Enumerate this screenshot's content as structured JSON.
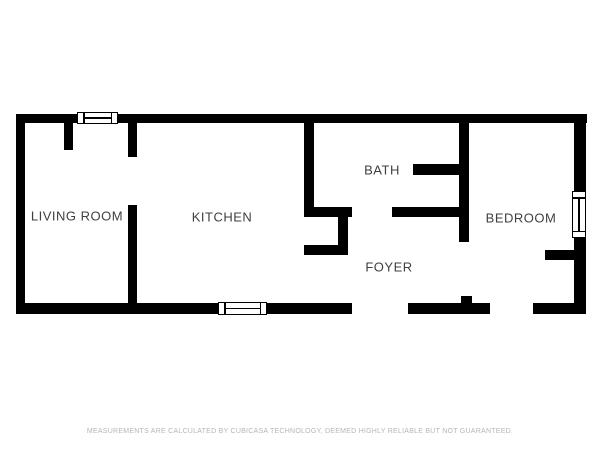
{
  "colors": {
    "background": "#ffffff",
    "wall": "#000000",
    "label": "#3f3f3f",
    "disclaimer": "#b5b5b5"
  },
  "rooms": [
    {
      "name": "living-room",
      "label": "LIVING ROOM"
    },
    {
      "name": "kitchen",
      "label": "KITCHEN"
    },
    {
      "name": "bath",
      "label": "BATH"
    },
    {
      "name": "foyer",
      "label": "FOYER"
    },
    {
      "name": "bedroom",
      "label": "BEDROOM"
    }
  ],
  "disclaimer": "MEASUREMENTS ARE CALCULATED BY CUBICASA TECHNOLOGY, DEEMED HIGHLY RELIABLE BUT NOT GUARANTEED.",
  "floorplan": {
    "walls": [
      {
        "id": "outer-top",
        "x": 16,
        "y": 114,
        "w": 571,
        "h": 9
      },
      {
        "id": "outer-left",
        "x": 16,
        "y": 114,
        "w": 9,
        "h": 200
      },
      {
        "id": "outer-right",
        "x": 574,
        "y": 114,
        "w": 12,
        "h": 200
      },
      {
        "id": "outer-bottom-left",
        "x": 16,
        "y": 303,
        "w": 336,
        "h": 11
      },
      {
        "id": "outer-bottom-mid",
        "x": 408,
        "y": 303,
        "w": 82,
        "h": 11
      },
      {
        "id": "outer-bottom-right",
        "x": 533,
        "y": 303,
        "w": 53,
        "h": 11
      },
      {
        "id": "living-room-stub",
        "x": 64,
        "y": 123,
        "w": 9,
        "h": 27
      },
      {
        "id": "living-kitchen-upper",
        "x": 128,
        "y": 123,
        "w": 9,
        "h": 34
      },
      {
        "id": "living-kitchen-lower",
        "x": 128,
        "y": 205,
        "w": 9,
        "h": 98
      },
      {
        "id": "kitchen-bath-divider",
        "x": 304,
        "y": 123,
        "w": 10,
        "h": 94
      },
      {
        "id": "bath-bottom-left",
        "x": 304,
        "y": 207,
        "w": 48,
        "h": 10
      },
      {
        "id": "bath-bottom-right",
        "x": 392,
        "y": 207,
        "w": 68,
        "h": 10
      },
      {
        "id": "foyer-closet-right",
        "x": 338,
        "y": 217,
        "w": 10,
        "h": 28
      },
      {
        "id": "foyer-closet-bottom",
        "x": 304,
        "y": 245,
        "w": 44,
        "h": 10
      },
      {
        "id": "bath-interior-stub",
        "x": 413,
        "y": 164,
        "w": 50,
        "h": 11
      },
      {
        "id": "bath-bedroom-divider",
        "x": 459,
        "y": 123,
        "w": 10,
        "h": 119
      },
      {
        "id": "foyer-bedroom-stub",
        "x": 461,
        "y": 296,
        "w": 11,
        "h": 8
      },
      {
        "id": "bedroom-closet-stub",
        "x": 545,
        "y": 250,
        "w": 29,
        "h": 10
      }
    ],
    "windows": [
      {
        "id": "living-room-window",
        "x": 77,
        "y": 112,
        "w": 41,
        "h": 12,
        "orient": "h"
      },
      {
        "id": "kitchen-window",
        "x": 218,
        "y": 302,
        "w": 49,
        "h": 13,
        "orient": "h"
      },
      {
        "id": "bedroom-window",
        "x": 572,
        "y": 191,
        "w": 14,
        "h": 47,
        "orient": "v"
      }
    ]
  }
}
